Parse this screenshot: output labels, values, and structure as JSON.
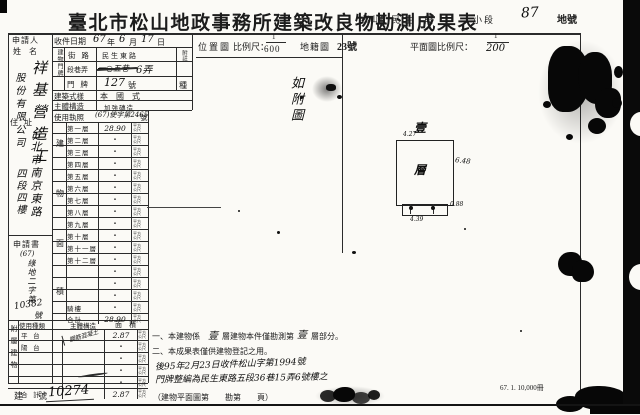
{
  "title": "臺北市松山地政事務所建築改良物勘測成果表",
  "header_right": {
    "district": "松山區",
    "section_name": "民生",
    "section_label": "段",
    "subsection_label": "小段",
    "lot_number": "87",
    "lot_label": "地號"
  },
  "applicant": {
    "label": "申請人",
    "name_label": "姓 名",
    "name_hw_col1": "祥基營造工",
    "name_hw_col2": "股份有限公司",
    "address_label": "住 址",
    "address_hw_col1": "台北市南京東路",
    "address_hw_col2": "四段四樓",
    "form_label": "申請書",
    "form_no_prefix_hw": "(67)",
    "form_no_mid_hw": "綠地二字第",
    "form_no_digits_hw": "10382",
    "form_no_suffix_hw": "號"
  },
  "receipt": {
    "label": "收件日期",
    "year": "67",
    "year_unit": "年",
    "month": "6",
    "month_unit": "月",
    "day": "17",
    "day_unit": "日"
  },
  "door": {
    "side_label": "建物門牌",
    "note_label": "附註",
    "street_label": "街 路",
    "street_value": "民生東路",
    "lane_label": "段巷弄",
    "lane_struck_hw": "一○五巷",
    "lane_value_hw": "6弄",
    "plate_label": "門 牌",
    "plate_value_hw": "127",
    "plate_unit": "號",
    "plate_extra": "種"
  },
  "style_row": {
    "label": "建築式樣",
    "value": "本　國　式"
  },
  "structure_row": {
    "label": "主體構造",
    "value": "加強磚造"
  },
  "license_row": {
    "label": "使用執照",
    "hw": "(67)使字第2465",
    "suffix": "號"
  },
  "floor_table": {
    "side_label_chars": [
      "建",
      "物",
      "面",
      "積"
    ],
    "unit": "平方公尺",
    "rows": [
      {
        "label": "第一層",
        "value": "28.90",
        "hw": true
      },
      {
        "label": "第二層",
        "value": "・"
      },
      {
        "label": "第三層",
        "value": "・"
      },
      {
        "label": "第四層",
        "value": "・"
      },
      {
        "label": "第五層",
        "value": "・"
      },
      {
        "label": "第六層",
        "value": "・"
      },
      {
        "label": "第七層",
        "value": "・"
      },
      {
        "label": "第八層",
        "value": "・"
      },
      {
        "label": "第九層",
        "value": "・"
      },
      {
        "label": "第十層",
        "value": "・"
      },
      {
        "label": "第十一層",
        "value": "・"
      },
      {
        "label": "第十二層",
        "value": "・"
      },
      {
        "label": "",
        "value": "・"
      },
      {
        "label": "",
        "value": "・"
      },
      {
        "label": "",
        "value": "・"
      },
      {
        "label": "騎樓",
        "value": "・"
      },
      {
        "label": "合計",
        "value": "28.90",
        "hw": true
      }
    ]
  },
  "annex_table": {
    "side_label_chars": [
      "附",
      "屬",
      "建",
      "物"
    ],
    "headers": {
      "use": "使用種類",
      "structure": "主體構造",
      "area": "面　積"
    },
    "unit": "平方公尺",
    "rows": [
      {
        "label": "平 台",
        "structure": "鋼筋混凝土",
        "value": "2.87",
        "hw": true,
        "diag": true
      },
      {
        "label": "陽 台",
        "structure": "",
        "value": "・"
      },
      {
        "label": "",
        "structure": "",
        "value": "・"
      },
      {
        "label": "",
        "structure": "",
        "value": "・"
      },
      {
        "label": "",
        "structure": "",
        "value": "・"
      },
      {
        "label": "合 計",
        "structure": "",
        "value": "2.87",
        "hw": true
      }
    ]
  },
  "building_no": {
    "label": "建　號",
    "value_hw": "10274"
  },
  "location_map": {
    "label": "位置圖",
    "scale_label": "比例尺：",
    "scale_num": "1",
    "scale_den": "600",
    "cadastral_label": "地籍圖",
    "sheet": "23號",
    "annotation_hw": "如附圖"
  },
  "floor_plan": {
    "scale_label": "平面圖比例尺：",
    "scale_num": "1",
    "scale_den_hw": "200",
    "floor_char_hw": "壹",
    "top_dim_hw": "4.27",
    "center_char_hw": "層",
    "right_dim_hw": "6.48",
    "strip_dim_hw": "0.88",
    "bottom_dim_hw": "4.39"
  },
  "notes": {
    "n1a": "一、本建物係",
    "n1_hw1": "壹",
    "n1b": "層建物本件僅勘測第",
    "n1_hw2": "壹",
    "n1c": "層部分。",
    "n2": "二、本成果表僅供建物登記之用。",
    "hw_line1": "後95年2月23日收件松山字第1994號",
    "hw_line2": "門牌整編為民生東路五段36巷15弄6號樓之"
  },
  "footer": {
    "page_ref": "（建物平面圖第　　勘第　　頁）",
    "print_code": "67. 1. 10,000冊"
  }
}
